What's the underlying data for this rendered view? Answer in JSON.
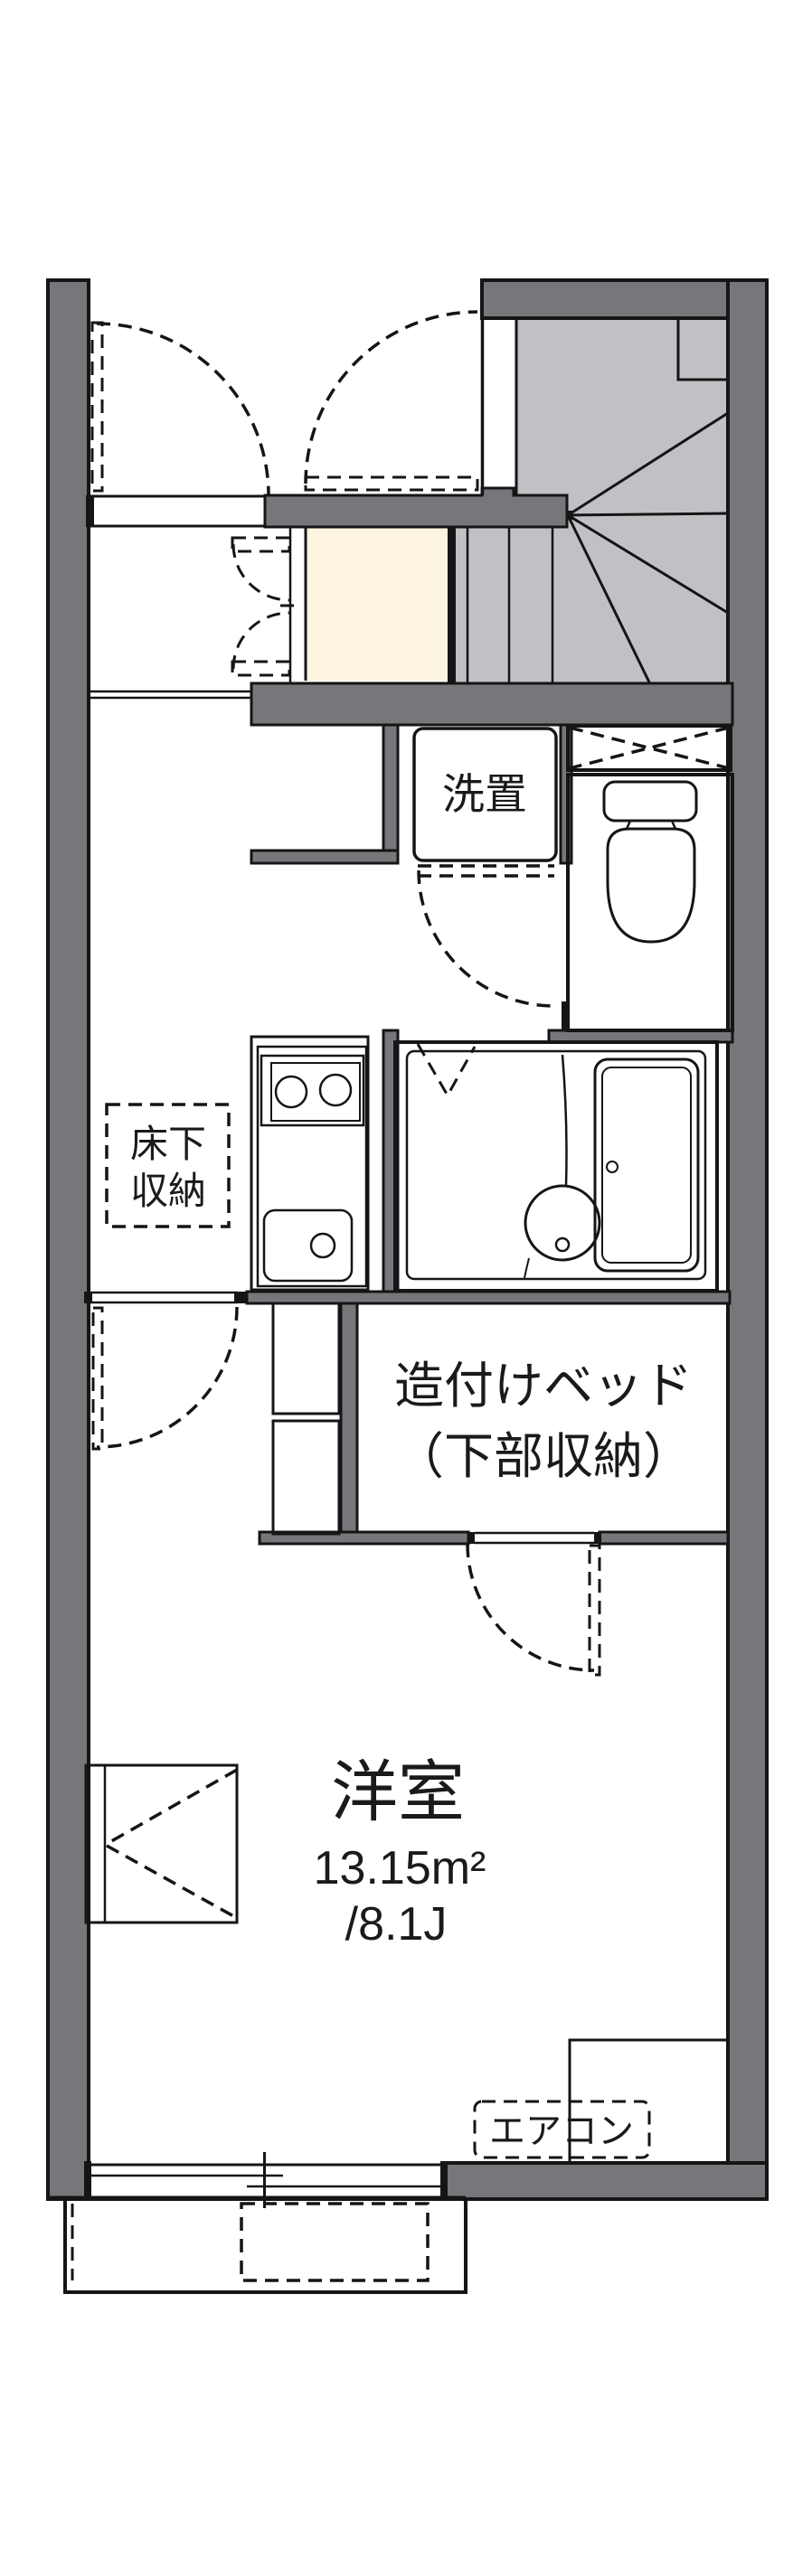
{
  "title": "apartment floor plan",
  "labels": {
    "laundry": "洗置",
    "underfloor_storage_line1": "床下",
    "underfloor_storage_line2": "収納",
    "built_in_bed_line1": "造付けベッド",
    "built_in_bed_line2": "（下部収納）",
    "room_name": "洋室",
    "room_area_sqm": "13.15m²",
    "room_area_tatami": "/8.1J",
    "aircon": "エアコン"
  },
  "room": {
    "name": "洋室",
    "area_m2": 13.15,
    "area_jo": 8.1
  },
  "colors": {
    "wall": "#77777b",
    "stairs": "#c1c1c5",
    "fixture_blue": "#dce7f7",
    "bath_floor": "#e6eefb",
    "cream": "#fcf4df",
    "line": "#151515"
  }
}
